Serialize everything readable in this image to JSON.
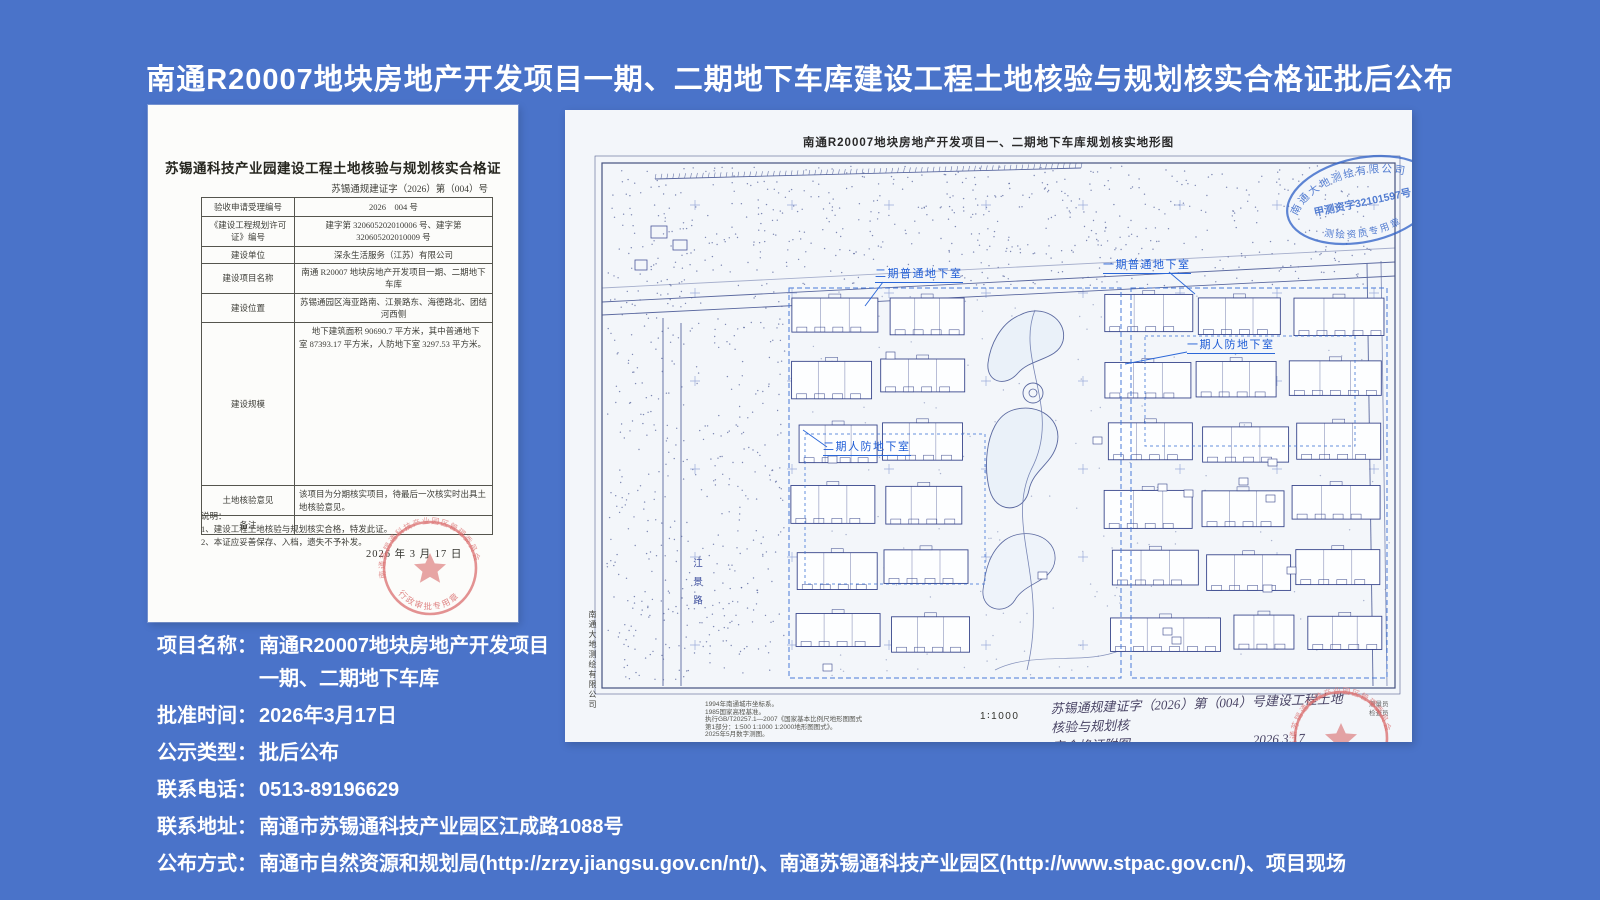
{
  "page": {
    "title": "南通R20007地块房地产开发项目一期、二期地下车库建设工程土地核验与规划核实合格证批后公布",
    "bg_color": "#4a73c9",
    "title_color": "#ffffff"
  },
  "certificate": {
    "title": "苏锡通科技产业园建设工程土地核验与规划核实合格证",
    "doc_no": "苏锡通规建证字（2026）第（004）号",
    "rows": [
      {
        "label": "验收申请受理编号",
        "value": "2026　004 号"
      },
      {
        "label": "《建设工程规划许可证》编号",
        "value": "建字第 320605202010006 号、建字第 320605202010009 号"
      },
      {
        "label": "建设单位",
        "value": "深永生活服务（江苏）有限公司"
      },
      {
        "label": "建设项目名称",
        "value": "南通 R20007 地块房地产开发项目一期、二期地下车库"
      },
      {
        "label": "建设位置",
        "value": "苏锡通园区海亚路南、江景路东、海德路北、团结河西侧"
      },
      {
        "label": "建设规模",
        "value": "地下建筑面积 90690.7 平方米，其中普通地下室 87393.17 平方米，人防地下室 3297.53 平方米。"
      },
      {
        "label": "土地核验意见",
        "value": "该项目为分期核实项目，待最后一次核实时出具土地核验意见。"
      },
      {
        "label": "备注",
        "value": ""
      }
    ],
    "notes_heading": "说明：",
    "notes": [
      "1、建设工程土地核验与规划核实合格，特发此证。",
      "2、本证应妥善保存、入档，遗失不予补发。"
    ],
    "date": "2026 年 3 月 17 日",
    "stamp": {
      "top_arc": "南通苏锡通科技产业园区管理委员会",
      "bottom_arc": "行政审批专用章",
      "color": "#d96a6a"
    }
  },
  "map": {
    "title": "南通R20007地块房地产开发项目一、二期地下车库规划核实地形图",
    "labels": {
      "phase2_normal": "二期普通地下室",
      "phase1_normal": "一期普通地下室",
      "phase1_civil": "一期人防地下室",
      "phase2_civil": "二期人防地下室"
    },
    "road_label": "江景路",
    "surveyor_vertical": "南通大地测绘有限公司",
    "blue_stamp": {
      "top_arc": "南通大地测绘有限公司",
      "middle": "甲测资字32101597号",
      "bottom_arc": "测绘资质专用章",
      "color": "#2f62c8"
    },
    "scale": "1∶1000",
    "notes": [
      "1994年南通城市坐标系。",
      "1985国家高程基准。",
      "执行GB/T20257.1—2007《国家基本比例尺地形图图式",
      "第1部分：1:500 1:1000 1:2000地形图图式》。",
      "2025年5月数字测图。"
    ],
    "handwritten_line1": "苏锡通规建证字（2026）第（004）号建设工程土地核验与规划核",
    "handwritten_line2": "实合格证附图",
    "handwritten_date": "2026.3.17",
    "staff": [
      "测量员",
      "检查员"
    ],
    "red_stamp": {
      "top_arc": "南通苏锡通科技产业园区管理委员会",
      "bottom_arc": "行政审批专用章",
      "color": "#d96a6a"
    }
  },
  "info": {
    "rows": [
      {
        "label": "项目名称：",
        "lines": [
          "南通R20007地块房地产开发项目",
          "一期、二期地下车库"
        ]
      },
      {
        "label": "批准时间：",
        "lines": [
          "2026年3月17日"
        ]
      },
      {
        "label": "公示类型：",
        "lines": [
          "批后公布"
        ]
      },
      {
        "label": "联系电话：",
        "lines": [
          "0513-89196629"
        ]
      },
      {
        "label": "联系地址：",
        "lines": [
          "南通市苏锡通科技产业园区江成路1088号"
        ]
      },
      {
        "label": "公布方式：",
        "lines": [
          "南通市自然资源和规划局(http://zrzy.jiangsu.gov.cn/nt/)、南通苏锡通科技产业园区(http://www.stpac.gov.cn/)、项目现场"
        ]
      }
    ]
  }
}
